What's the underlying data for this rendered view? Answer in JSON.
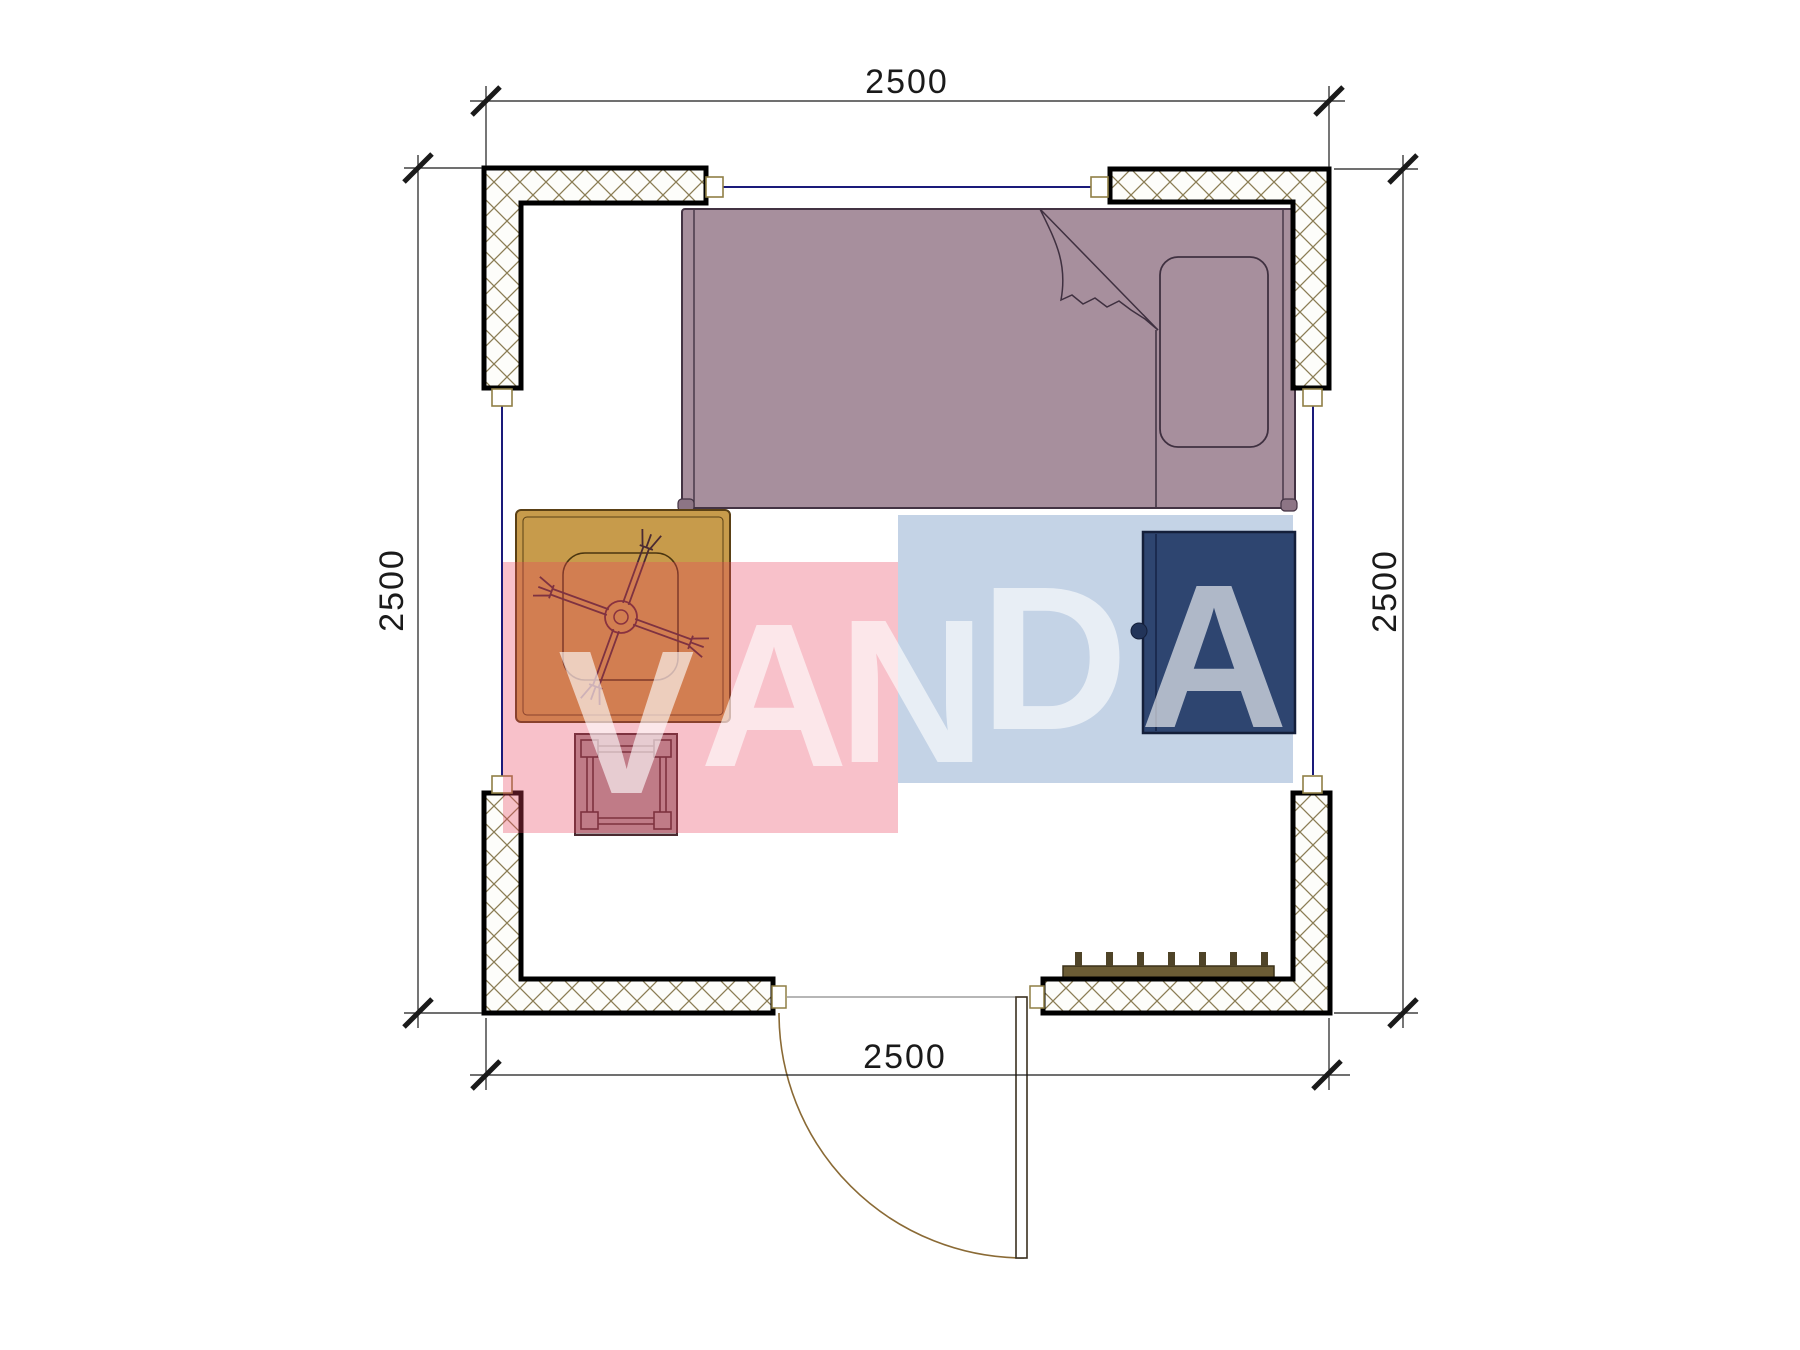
{
  "plan": {
    "type": "floor-plan",
    "room": {
      "width_label": "2500",
      "height_label": "2500"
    },
    "dimensions": {
      "top": "2500",
      "bottom": "2500",
      "left": "2500",
      "right": "2500"
    },
    "watermark": {
      "text": "VANDA",
      "letters": [
        "V",
        "A",
        "N",
        "D",
        "A"
      ]
    },
    "colors": {
      "bed_fill": "#a78f9d",
      "bed_outline": "#3f3040",
      "bed_foot": "#8d7585",
      "table_fill": "#c79b4b",
      "table_outline": "#5a4015",
      "stool_fill": "rgba(96,56,64,0.52)",
      "stool_outline": "#4a2a30",
      "cabinet_fill": "#2e4570",
      "cabinet_outline": "#141f3a",
      "red_band": "rgba(233,66,95,0.33)",
      "blue_band": "rgba(108,146,192,0.40)",
      "watermark_letters": "#ffffff",
      "wall_hatch": "#8b7d55",
      "wall_outline": "#000000",
      "window_glazing": "#1a1a7a",
      "window_frame": "#8f7f45",
      "door_swing": "#8a6a35",
      "door_leaf_outline": "#3a3020",
      "radiator_fill": "#6b5c35",
      "radiator_teeth": "#4f4428",
      "dimension_ink": "#1a1a1a"
    },
    "elements": [
      "single-bed",
      "pillow",
      "blanket-fold",
      "square-table",
      "fan-symbol",
      "stool",
      "cabinet",
      "door",
      "door-swing-arc",
      "radiator",
      "hatched-walls",
      "windows",
      "dimension-lines"
    ]
  }
}
